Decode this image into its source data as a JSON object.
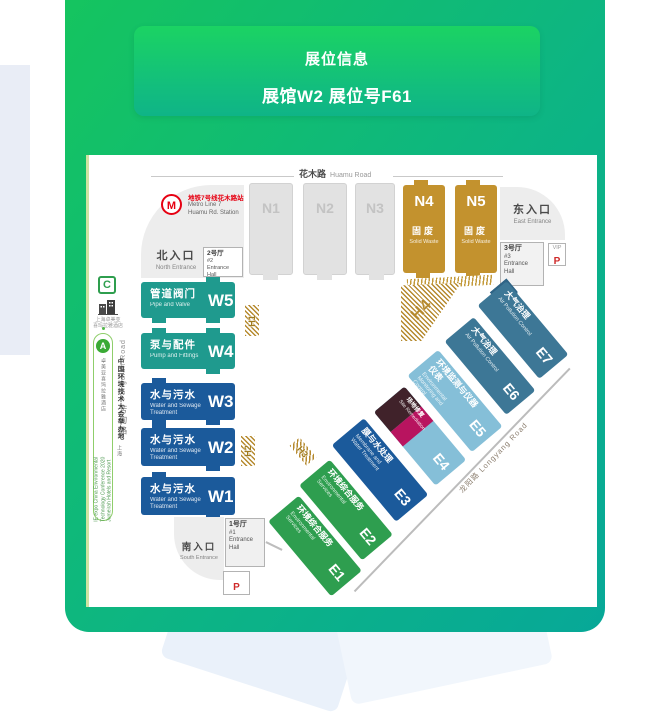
{
  "header": {
    "title": "展位信息",
    "subtitle": "展馆W2 展位号F61"
  },
  "colors": {
    "teal": "#1f9a8e",
    "blue": "#1b5a9b",
    "steel": "#3d7796",
    "light": "#85bfd8",
    "green": "#2e9e4f",
    "gold": "#c3922e",
    "maroon": "#40222a",
    "crimson": "#b8145f",
    "hatch_gold": "#b5892d",
    "metro_red": "#e60012",
    "panel_green": "#0db583"
  },
  "map": {
    "roads": {
      "huamu_zh": "花木路",
      "huamu_en": "Huamu Road",
      "fangdian_zh": "芳甸路",
      "fangdian_en": "Fangdian Road",
      "longyang": "龙阳路  Longyang Road"
    },
    "metro": {
      "logo": "M",
      "zh": "地铁7号线花木路站",
      "en1": "Metro Line 7",
      "en2": "Huamu Rd. Station"
    },
    "north": {
      "zh": "北入口",
      "en": "North Entrance"
    },
    "east": {
      "zh": "东入口",
      "en": "East Entrance"
    },
    "south": {
      "zh": "南入口",
      "en": "South Entrance"
    },
    "hall2": {
      "zh": "2号厅",
      "num": "#2",
      "en": "Entrance Hall"
    },
    "hall3": {
      "zh": "3号厅",
      "num": "#3",
      "en": "Entrance Hall"
    },
    "hall1": {
      "zh": "1号厅",
      "num": "#1",
      "en1": "Entrance",
      "en2": "Hall"
    },
    "vip": {
      "label": "VIP",
      "p": "P"
    },
    "parking_south": {
      "p": "P"
    },
    "n_halls": [
      {
        "id": "N1"
      },
      {
        "id": "N2"
      },
      {
        "id": "N3"
      },
      {
        "id": "N4",
        "zh": "固废",
        "en": "Solid Waste"
      },
      {
        "id": "N5",
        "zh": "固废",
        "en": "Solid Waste"
      }
    ],
    "w_halls": [
      {
        "id": "W5",
        "zh": "管道阀门",
        "en": "Pipe and Valve"
      },
      {
        "id": "W4",
        "zh": "泵与配件",
        "en": "Pump and Fittings"
      },
      {
        "id": "W3",
        "zh": "水与污水",
        "en": "Water and Sewage Treatment"
      },
      {
        "id": "W2",
        "zh": "水与污水",
        "en": "Water and Sewage Treatment"
      },
      {
        "id": "W1",
        "zh": "水与污水",
        "en": "Water and Sewage Treatment"
      }
    ],
    "e_halls": [
      {
        "id": "E7",
        "zh": "大气治理",
        "en": "Air Pollution Control"
      },
      {
        "id": "E6",
        "zh": "大气治理",
        "en": "Air Pollution Control"
      },
      {
        "id": "E5",
        "zh": "环境监测与仪器仪表",
        "en": "Environmental Monitoring and Control"
      },
      {
        "id": "E4",
        "zh": "场地修复",
        "en": "Site Remediation"
      },
      {
        "id": "E3",
        "zh": "膜与水处理",
        "en": "Membrane and Water Treatment"
      },
      {
        "id": "E2",
        "zh": "环境综合服务",
        "en": "Environmental Services"
      },
      {
        "id": "E1",
        "zh": "环境综合服务",
        "en": "Environmental Services"
      }
    ],
    "connectors": [
      "H1",
      "H2",
      "H3",
      "H4"
    ],
    "legend": {
      "c_badge": "C",
      "hotel_line1": "上海卓美亚",
      "hotel_line2": "喜玛拉雅酒店",
      "a_badge": "A",
      "pill_zh_bold": "中国环境技术大会举办地",
      "pill_zh_small": "上海卓美亚喜玛拉雅酒店",
      "pill_en1": "IE expo China Environmental",
      "pill_en2": "Technology Conference 2020",
      "pill_en3": "Jumeirah Hotels and Resort"
    }
  }
}
